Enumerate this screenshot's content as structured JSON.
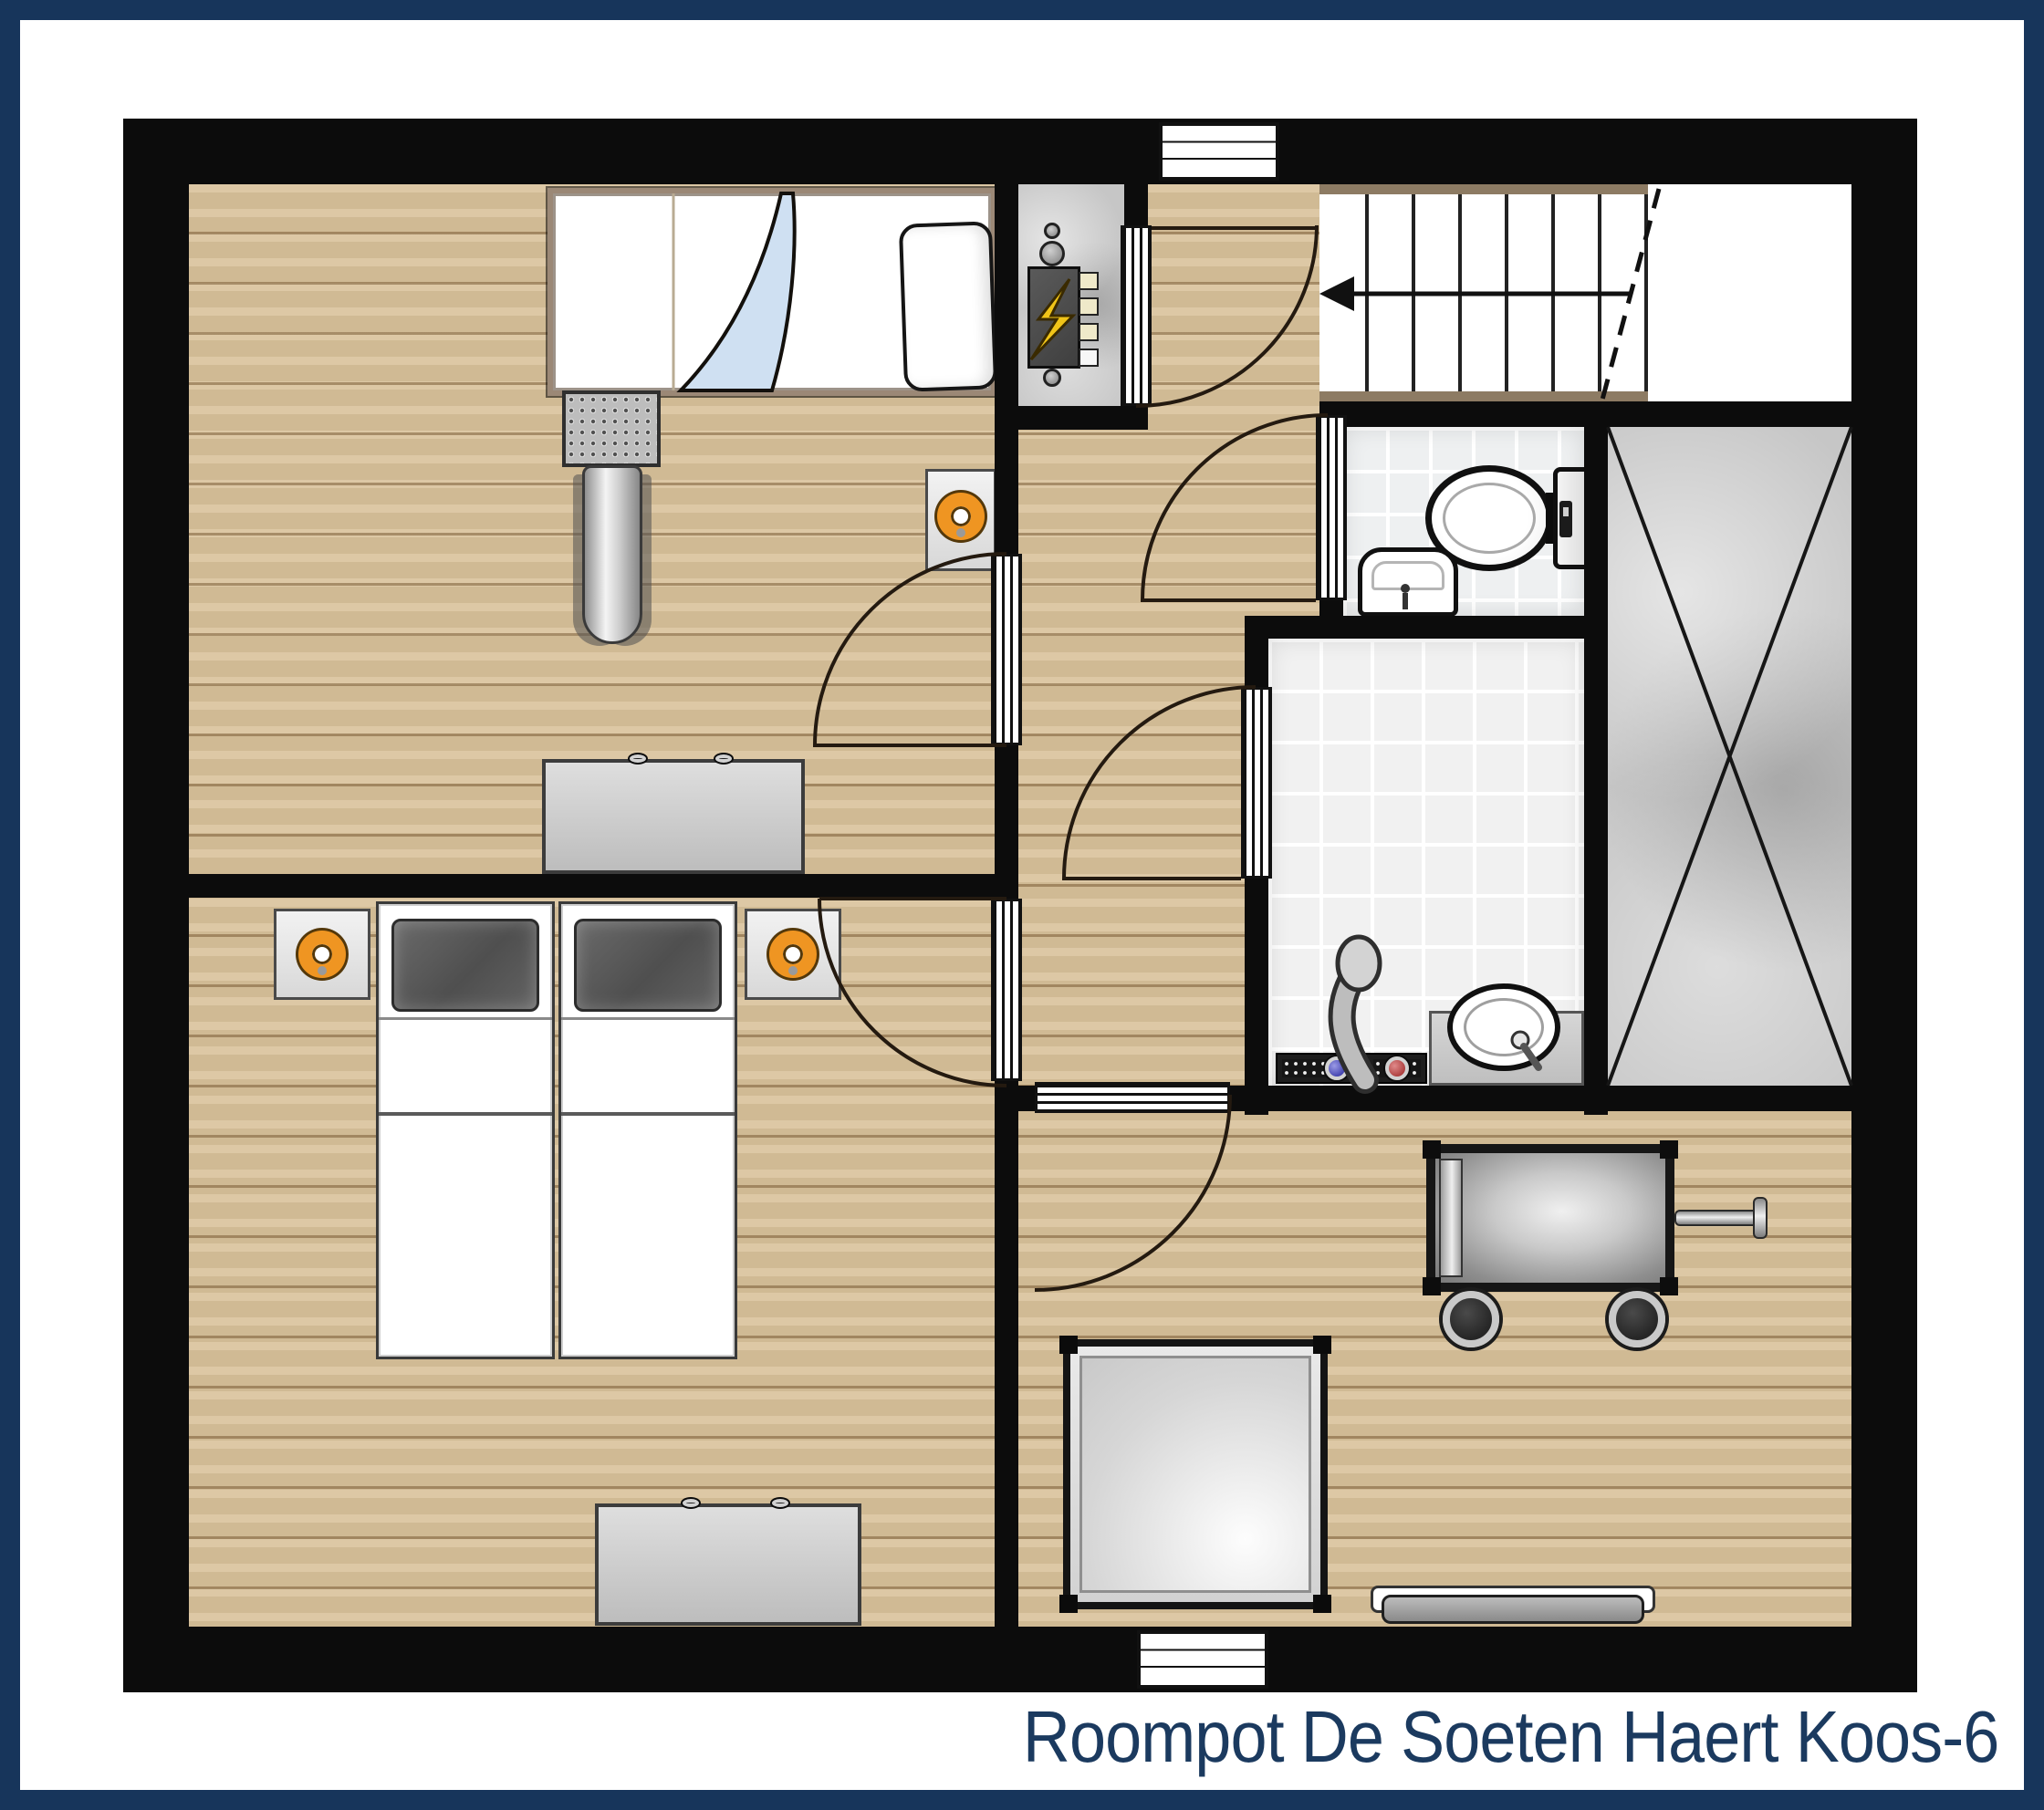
{
  "caption": {
    "text": "Roompot De Soeten Haert Koos-6"
  },
  "colors": {
    "frame": "#17355b",
    "wall": "#0c0c0c",
    "floor": "#d9c29b",
    "tile": "#eef0f1",
    "concrete": "#c6c6c6",
    "stairTrim": "#8d7b63",
    "lamp": "#ef9522",
    "blanket": "#cfe0f2",
    "bolt": "#f0c419",
    "navyText": "#1b3a5f",
    "chrome": "#c9c9c9"
  },
  "plan": {
    "type": "floor-plan",
    "stair_step_count": 7,
    "stair_direction": "arrow-left-down",
    "rooms": [
      {
        "id": "bedroom-top",
        "fixtures": [
          "single-bed",
          "blue-blanket",
          "pillow",
          "chrome-ladder-slide",
          "nightstand-with-orange-lamp",
          "dresser"
        ]
      },
      {
        "id": "bedroom-bottom",
        "fixtures": [
          "twin-bed-left",
          "twin-bed-right",
          "nightstand-with-orange-lamp-left",
          "nightstand-with-orange-lamp-right",
          "dresser"
        ]
      },
      {
        "id": "landing",
        "fixtures": [
          "staircase-with-down-arrow",
          "meter-cupboard-electrical-panel"
        ]
      },
      {
        "id": "toilet-room",
        "fixtures": [
          "toilet-with-cistern",
          "corner-washbasin"
        ]
      },
      {
        "id": "bathroom",
        "fixtures": [
          "shower-mixer-hot-cold",
          "washbasin-on-counter"
        ]
      },
      {
        "id": "void-storage",
        "fixtures": [
          "x-cross-marking"
        ]
      },
      {
        "id": "living-area",
        "fixtures": [
          "cot-on-wheels",
          "square-table",
          "wall-radiator"
        ]
      }
    ],
    "windows": [
      "top-wall-window",
      "bottom-wall-window"
    ],
    "doors": [
      "bedroom-top-door",
      "bedroom-bottom-door",
      "living-area-door",
      "meter-cupboard-door",
      "toilet-door",
      "bathroom-door"
    ]
  }
}
